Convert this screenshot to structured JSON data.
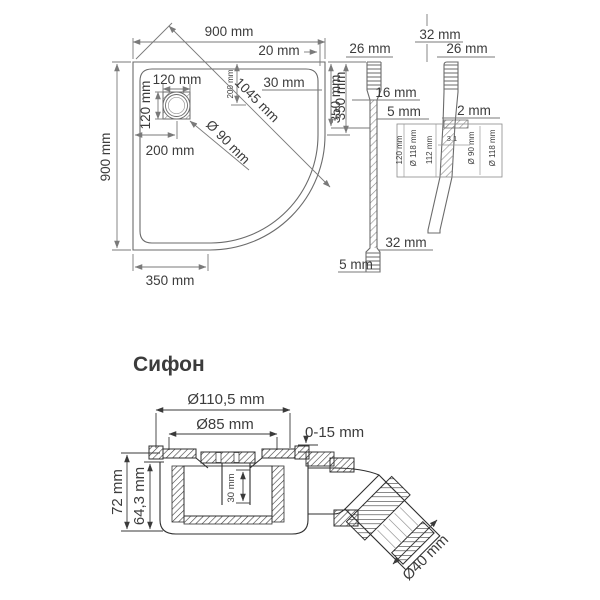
{
  "colors": {
    "title_blue": "#2d3a6b",
    "line_dark": "#2f2f2f",
    "line_gray": "#7a7a7a",
    "text": "#3c3c3c"
  },
  "tray_top_view": {
    "width_top": "900 mm",
    "rim_top_right": "20 mm",
    "drain_width": "120 mm",
    "drain_center_from_top_small": "200 mm",
    "inner_rim_right": "30 mm",
    "diagonal": "1045 mm",
    "right_straight_edge": "350 mm",
    "drain_height": "120 mm",
    "drain_diameter": "Ø 90 mm",
    "drain_center_from_left": "200 mm",
    "height_left": "900 mm",
    "bottom_straight_edge": "350 mm"
  },
  "tray_section_left": {
    "top_thickness": "26 mm",
    "upper_span": "350 mm",
    "step": "16 mm",
    "lip": "5 mm",
    "lower_span": "32 mm",
    "bottom_lip": "5 mm"
  },
  "tray_section_right": {
    "top_span": "32 mm",
    "top_edge": "26 mm",
    "gap": "2 mm",
    "detail": {
      "height": "120 mm",
      "outer_diameter": "Ø 118 mm",
      "inner_height": "112 mm",
      "slope": "3.1",
      "drain_diameter": "Ø 90 mm",
      "outer_diameter_2": "Ø 118 mm"
    }
  },
  "siphon": {
    "title": "Сифон",
    "outer_diameter": "Ø110,5 mm",
    "grate_diameter": "Ø85 mm",
    "adjustment_range": "0-15 mm",
    "total_height": "72 mm",
    "body_height": "64,3 mm",
    "cup_depth": "30 mm",
    "outlet_diameter": "Ø40 mm"
  }
}
